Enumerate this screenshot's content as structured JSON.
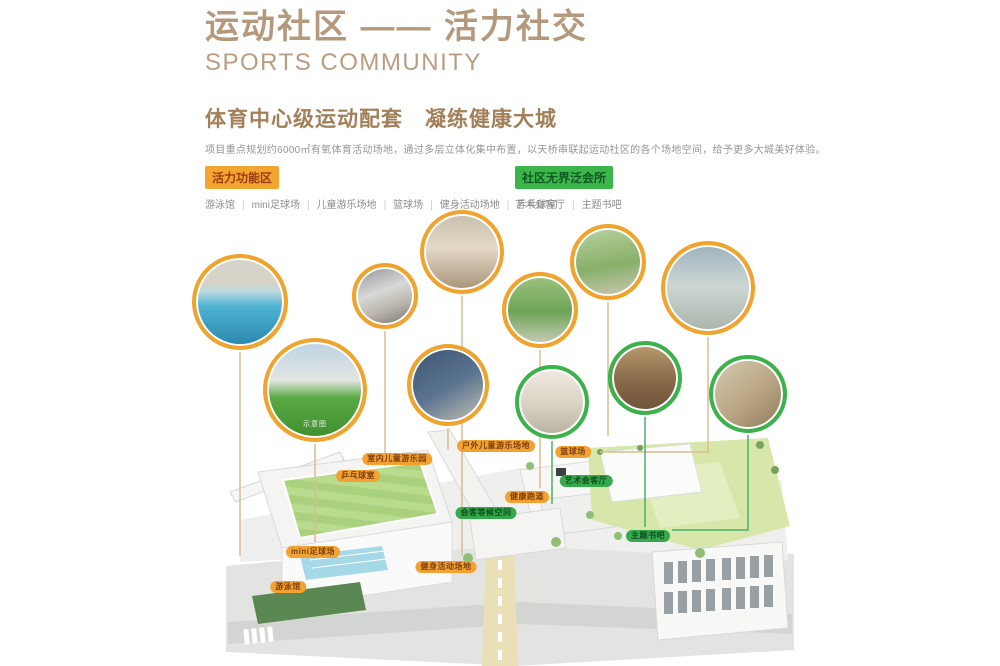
{
  "header": {
    "title": "运动社区 —— 活力社交",
    "subtitle": "SPORTS COMMUNITY"
  },
  "intro": {
    "heading": "体育中心级运动配套　凝练健康大城",
    "body": "项目重点规划约6000㎡有氧体育活动场地，通过多层立体化集中布置，以天桥串联起运动社区的各个场地空间，给予更多大城美好体验。"
  },
  "legend": {
    "separator": "|",
    "groups": [
      {
        "label": "活力功能区",
        "badge_bg": "#f2a52f",
        "badge_text": "#9c3b12",
        "items": [
          "游泳馆",
          "mini足球场",
          "儿童游乐场地",
          "篮球场",
          "健身活动场地",
          "乒乓球室"
        ]
      },
      {
        "label": "社区无界泛会所",
        "badge_bg": "#3cb54b",
        "badge_text": "#0d5a20",
        "items": [
          "艺术会客厅",
          "主题书吧"
        ]
      }
    ]
  },
  "photos": [
    {
      "name": "indoor-pool-photo",
      "ring": "orange"
    },
    {
      "name": "corridor-photo",
      "ring": "orange"
    },
    {
      "name": "fitness-room-photo",
      "ring": "orange"
    },
    {
      "name": "garden-path-photo",
      "ring": "orange"
    },
    {
      "name": "jogging-street-photo",
      "ring": "orange"
    },
    {
      "name": "community-street-photo",
      "ring": "orange"
    },
    {
      "name": "football-field-photo",
      "ring": "orange",
      "caption": "示意图"
    },
    {
      "name": "kids-climbing-room-photo",
      "ring": "orange"
    },
    {
      "name": "art-lounge-photo",
      "ring": "green"
    },
    {
      "name": "dining-hall-photo",
      "ring": "green"
    },
    {
      "name": "reading-room-photo",
      "ring": "green"
    }
  ],
  "plan": {
    "tags": [
      {
        "label": "室内儿童游乐园",
        "type": "orange"
      },
      {
        "label": "乒乓球室",
        "type": "orange"
      },
      {
        "label": "户外儿童游乐场地",
        "type": "orange"
      },
      {
        "label": "篮球场",
        "type": "orange"
      },
      {
        "label": "健康跑道",
        "type": "orange"
      },
      {
        "label": "健身活动场地",
        "type": "orange"
      },
      {
        "label": "mini足球场",
        "type": "orange"
      },
      {
        "label": "游泳馆",
        "type": "orange"
      },
      {
        "label": "艺术会客厅",
        "type": "green"
      },
      {
        "label": "会客等候空间",
        "type": "green"
      },
      {
        "label": "主题书吧",
        "type": "green"
      }
    ]
  },
  "colors": {
    "accent_orange": "#f0a42e",
    "accent_green": "#3cb24c",
    "title_tan": "#b5997c",
    "tag_orange_bg": "#f2a233",
    "tag_orange_text": "#7d3f0e",
    "tag_green_bg": "#35a94c",
    "tag_green_text": "#0e4d1e"
  }
}
